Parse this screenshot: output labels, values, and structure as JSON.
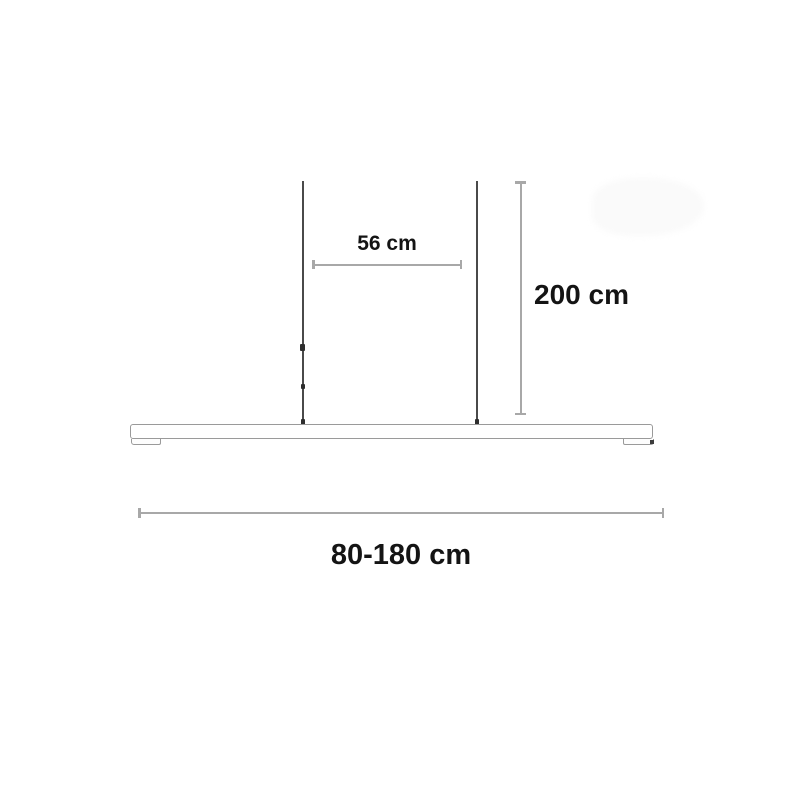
{
  "diagram": {
    "subject": "linear-pendant-lamp-dimension-drawing"
  },
  "labels": {
    "cable_spacing": "56 cm",
    "suspension_height": "200 cm",
    "fixture_width_range": "80-180 cm"
  },
  "colors": {
    "background": "#ffffff",
    "dimension_line": "#a8a8a8",
    "cable": "#4a4a4a",
    "fixture_outline": "#9a9a9a",
    "label_text": "#141414"
  }
}
